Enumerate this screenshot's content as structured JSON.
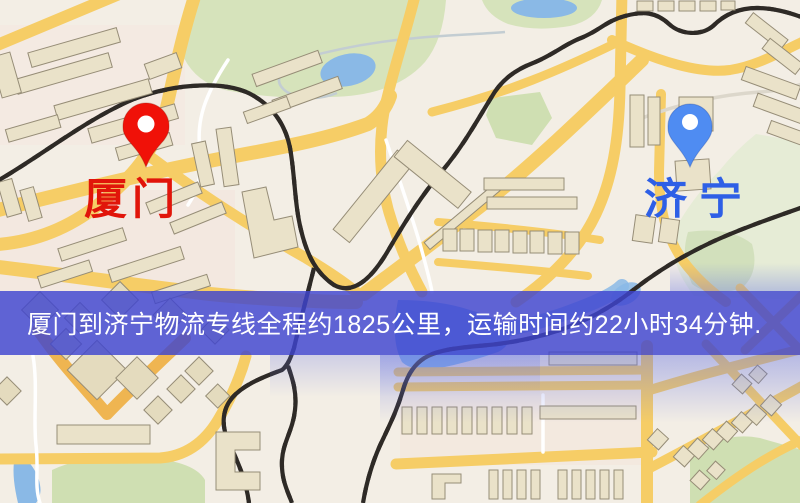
{
  "map": {
    "origin": {
      "label": "厦门",
      "pin_color": "#f01108",
      "label_color": "#e1150a"
    },
    "destination": {
      "label": "济宁",
      "pin_color": "#4f8cf2",
      "label_color": "#2e5fe6"
    },
    "banner": {
      "text": "厦门到济宁物流专线全程约1825公里，运输时间约22小时34分钟.",
      "background": "#3e44d0",
      "text_color": "#ffffff"
    },
    "theme": {
      "land": "#f3eee5",
      "road_major": "#f6cd66",
      "road_minor": "#ffffff",
      "park": "#d6e3bb",
      "water": "#8ab9e6",
      "building": "#eae2c9",
      "railway": "#2e2a26"
    }
  }
}
